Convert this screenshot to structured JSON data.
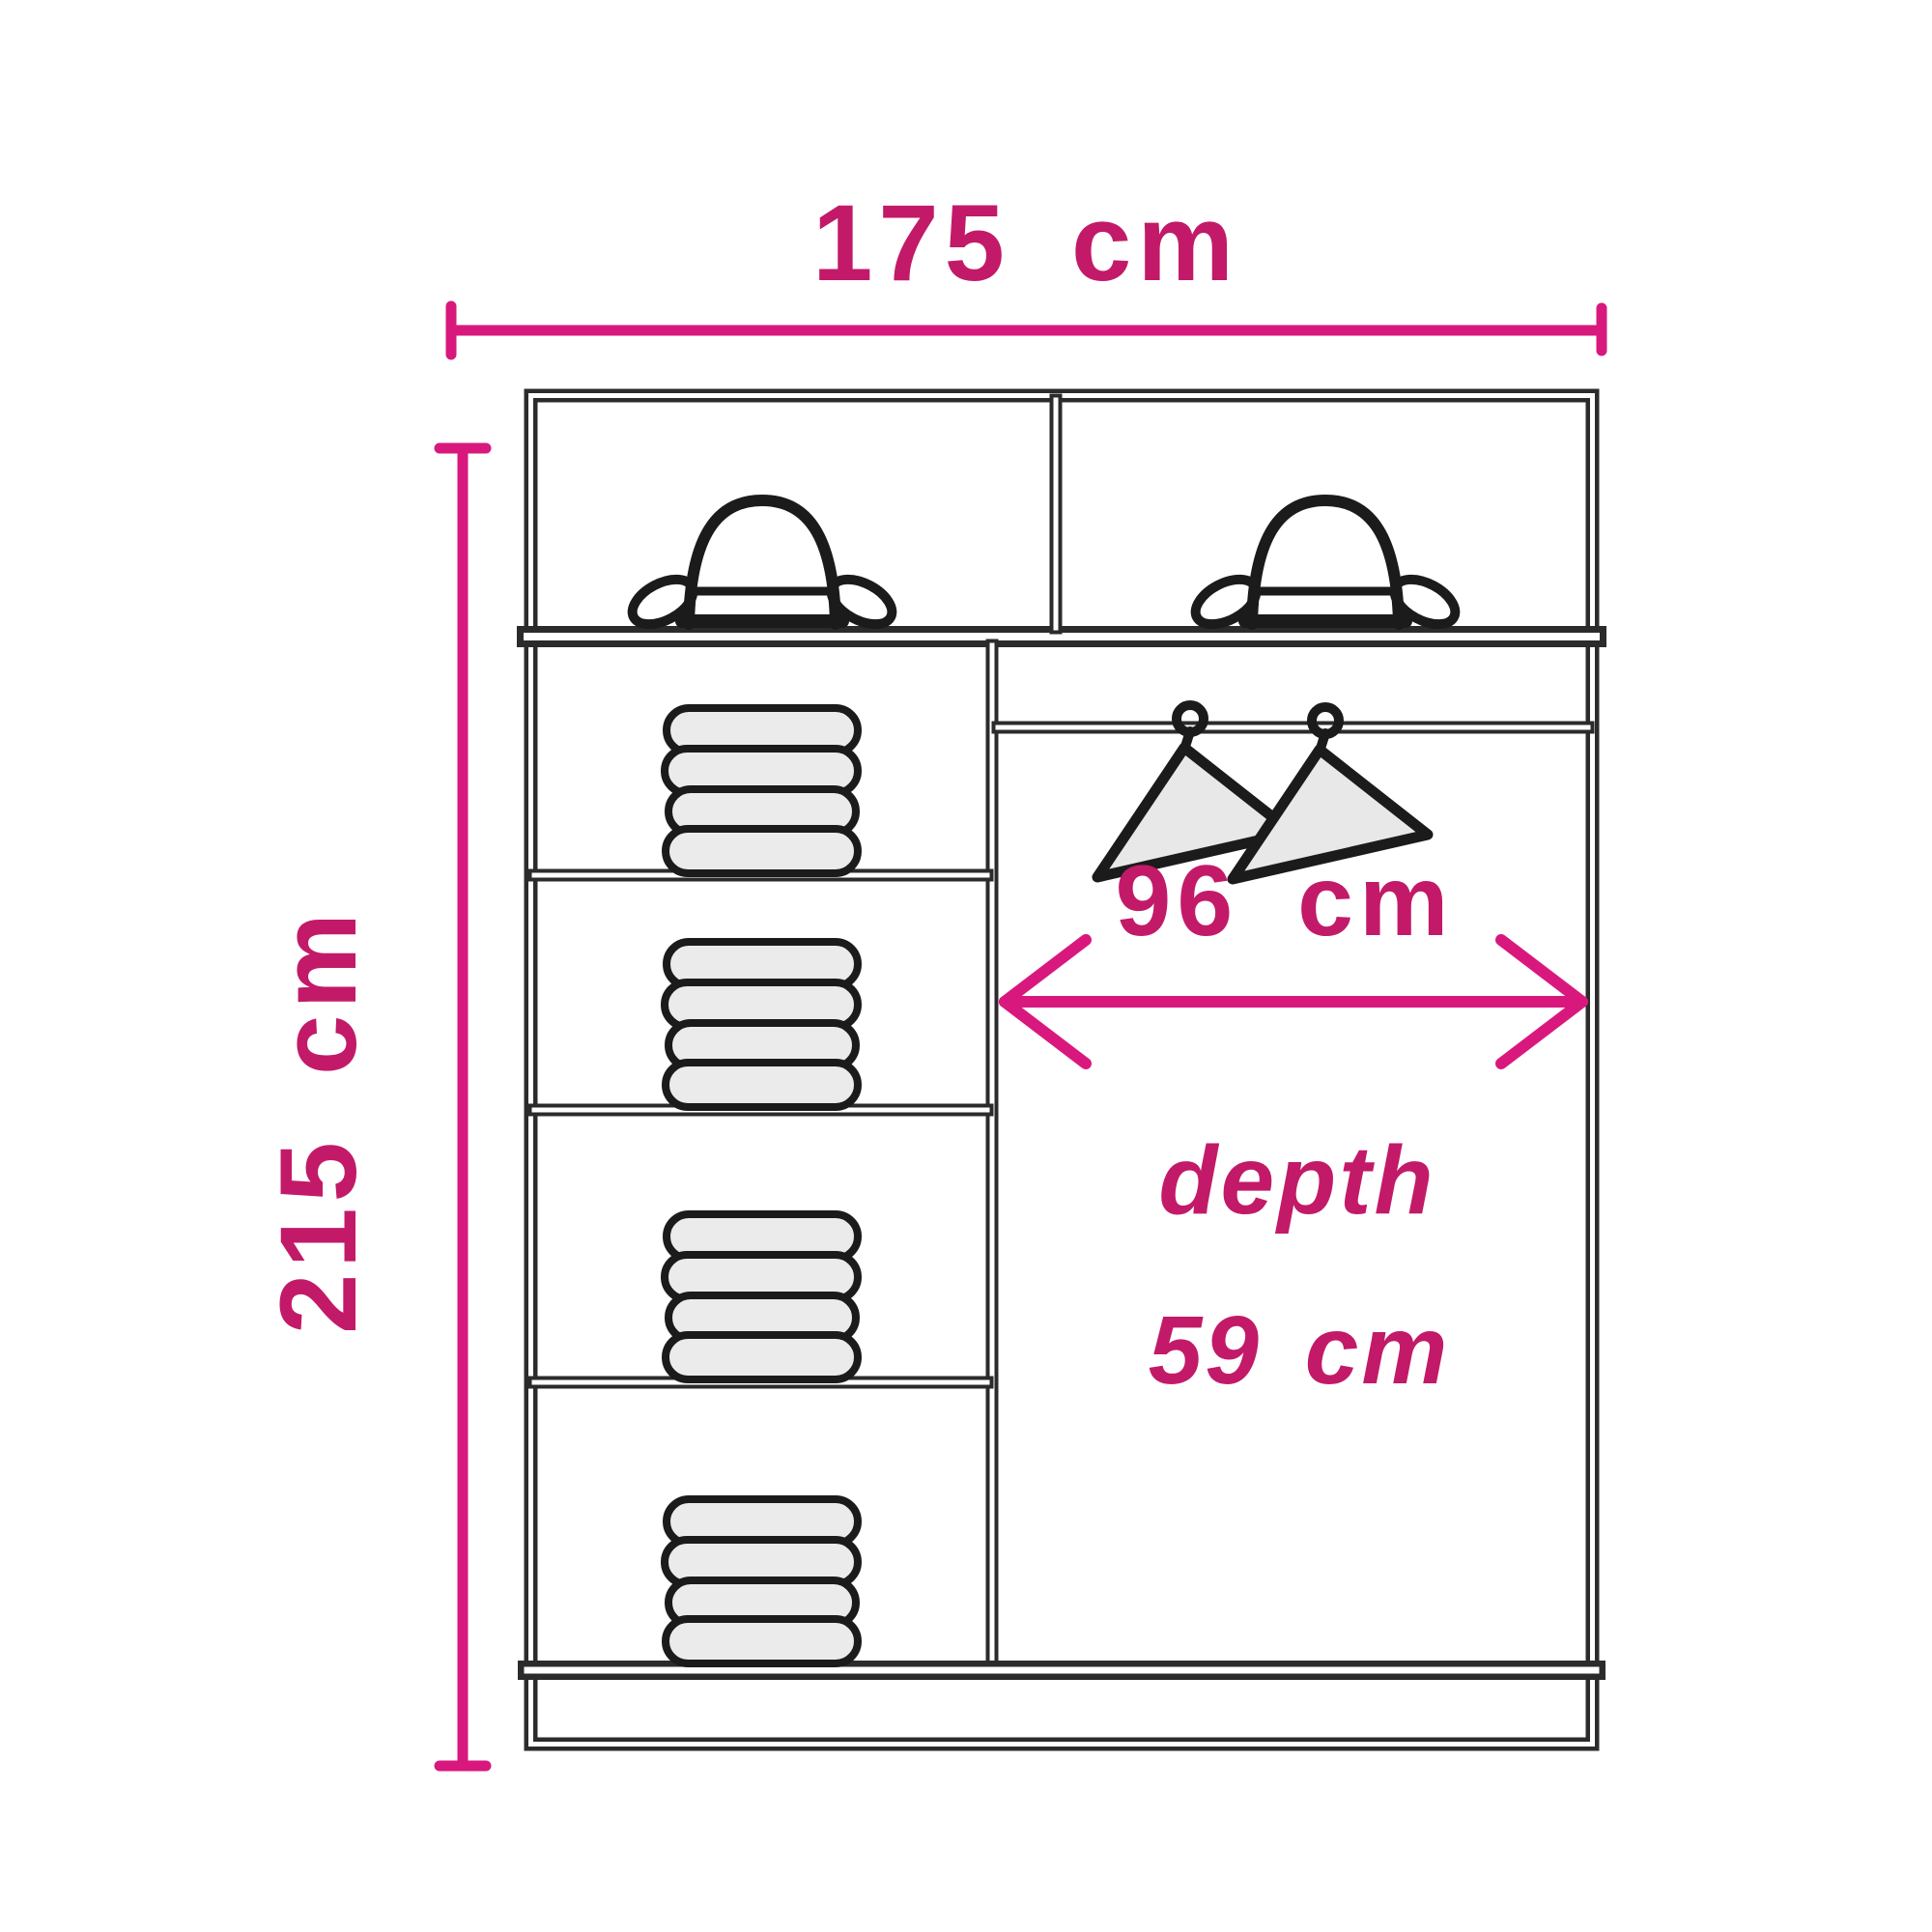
{
  "diagram": {
    "name": "wardrobe-internal-dimensions-diagram",
    "background": "#ffffff",
    "colors": {
      "outline": "#2b2b2b",
      "dimension_line": "#d9187e",
      "dimension_text": "#c21a68",
      "towel_fill": "#ebebeb",
      "hanger_fill": "#e8e8e8"
    },
    "labels": {
      "width": "175 cm",
      "height": "215 cm",
      "hanging_width": "96 cm",
      "depth_word": "depth",
      "depth_value": "59 cm"
    },
    "contents": {
      "hat_compartments": 2,
      "bowler_hats": 2,
      "towel_stacks": 4,
      "towels_per_stack": 4,
      "coat_hangers": 2,
      "left_column_shelves": 4,
      "hanging_rail": 1
    }
  }
}
